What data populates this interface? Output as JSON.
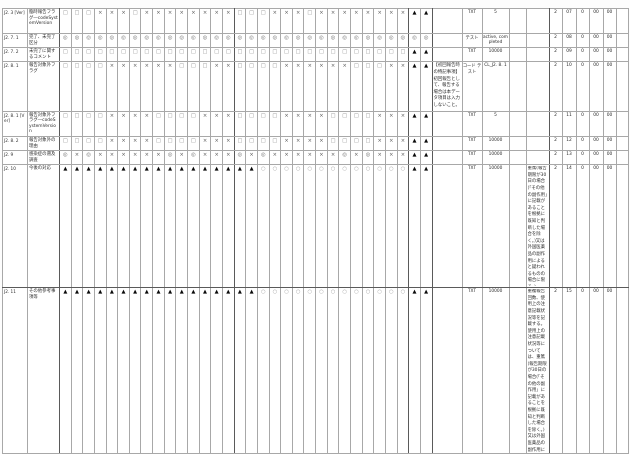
{
  "page": {
    "background_color": "#fdfdfd",
    "grid_line_color": "#a8a8a8",
    "symbol_colors": {
      "triangle": "#0a0a0a",
      "cross": "#5c5c5c",
      "square": "#8a8a8a",
      "double_circle": "#6e6e6e",
      "circle": "#a2a2a2"
    }
  },
  "table": {
    "rows": [
      {
        "id": "J2. 3 [Ver]",
        "label": "臨時報告フラグ―codeSystemVersion",
        "symbols": "□□□×××□××××××××□□□×××□××××××××▲▲",
        "remark_a": "",
        "type": "TXT",
        "value": "5",
        "aux": "",
        "remark_b": "",
        "nums": [
          "2",
          "07",
          "0",
          "00",
          "00"
        ],
        "tail": ""
      },
      {
        "id": "J2. 7. 1",
        "label": "完了、未完了区分",
        "symbols": "◎◎◎◎◎◎◎◎◎◎◎◎◎◎◎◎◎◎◎◎◎◎◎◎◎◎◎◎◎◎◎◎",
        "remark_a": "",
        "type": "テスト",
        "value": "active, completed",
        "aux": "",
        "remark_b": "",
        "nums": [
          "2",
          "08",
          "0",
          "00",
          "00"
        ],
        "tail": ""
      },
      {
        "id": "J2. 7. 2",
        "label": "未完了に関するコメント",
        "symbols": "□□□□□□□□□□□□□□□□□□□□□□□□□□□□□□▲▲",
        "remark_a": "",
        "type": "TXT",
        "value": "10000",
        "aux": "",
        "remark_b": "",
        "nums": [
          "2",
          "09",
          "0",
          "00",
          "00"
        ],
        "tail": ""
      },
      {
        "id": "J2. 8. 1",
        "label": "報告対象外フラグ",
        "symbols": "□□□□××××××□□□××□□□□××××××□□□××▲▲",
        "remark_a": "【初回報告時の特記事項】初回報告として、報告する場合は本データ項目は入力しないこと。",
        "type": "コード テスト",
        "value": "CL_J2. 8. 1",
        "aux": "",
        "remark_b": "",
        "nums": [
          "2",
          "10",
          "0",
          "00",
          "00"
        ],
        "tail": ""
      },
      {
        "id": "J2. 8. 1 [Ver]",
        "label": "報告対象外フラグ―codeSystemVersion",
        "symbols": "□□□□××××□□□□×××□□□□××××□□□□×××▲▲",
        "remark_a": "",
        "type": "TXT",
        "value": "5",
        "aux": "",
        "remark_b": "",
        "nums": [
          "2",
          "11",
          "0",
          "00",
          "00"
        ],
        "tail": ""
      },
      {
        "id": "J2. 8. 2",
        "label": "報告対象外の理由",
        "symbols": "□□□□××××□□□□×××□□□□××××□□□□×××▲▲",
        "remark_a": "",
        "type": "TXT",
        "value": "10000",
        "aux": "",
        "remark_b": "",
        "nums": [
          "2",
          "12",
          "0",
          "00",
          "00"
        ],
        "tail": ""
      },
      {
        "id": "J2. 9",
        "label": "感染症の遡及調査",
        "symbols": "◎×◎××××××◎×◎×××◎×◎××××××◎×◎×××▲▲",
        "remark_a": "",
        "type": "TXT",
        "value": "10000",
        "aux": "",
        "remark_b": "",
        "nums": [
          "2",
          "13",
          "0",
          "00",
          "00"
        ],
        "tail": ""
      },
      {
        "id": "J2. 10",
        "label": "今後の対応",
        "symbols": "▲▲▲▲▲▲▲▲▲▲▲▲▲▲▲▲▲○○○○○○○○○○○○○▲▲",
        "remark_a": "",
        "type": "TXT",
        "value": "10000",
        "aux": "",
        "remark_b": "重篤(報告期限が30日の場合(「その他の副作用」に記載があることを根拠に既知と判断した場合を除く。)又は外国医薬品の副作用によると疑われるものの場合に限る。)",
        "nums": [
          "2",
          "14",
          "0",
          "00",
          "00"
        ],
        "tail": ""
      },
      {
        "id": "J2. 11",
        "label": "その他参考事項等",
        "symbols": "▲▲▲▲▲▲▲▲▲▲▲▲▲▲▲▲▲○○○○○○○○○○○○○▲▲",
        "remark_a": "",
        "type": "TXT",
        "value": "10000",
        "aux": "",
        "remark_b": "重複報告回数、使用上の注意記載状況等を記載する。使用上の注意記載状況等については、重篤(報告期限が30日の場合(「その他の副作用」に記載があることを根拠に既知と判断した場合を除く。)又は外国医薬品の副作用によると疑われるものの場合に限る。)",
        "nums": [
          "2",
          "15",
          "0",
          "00",
          "00"
        ],
        "tail": ""
      }
    ]
  }
}
